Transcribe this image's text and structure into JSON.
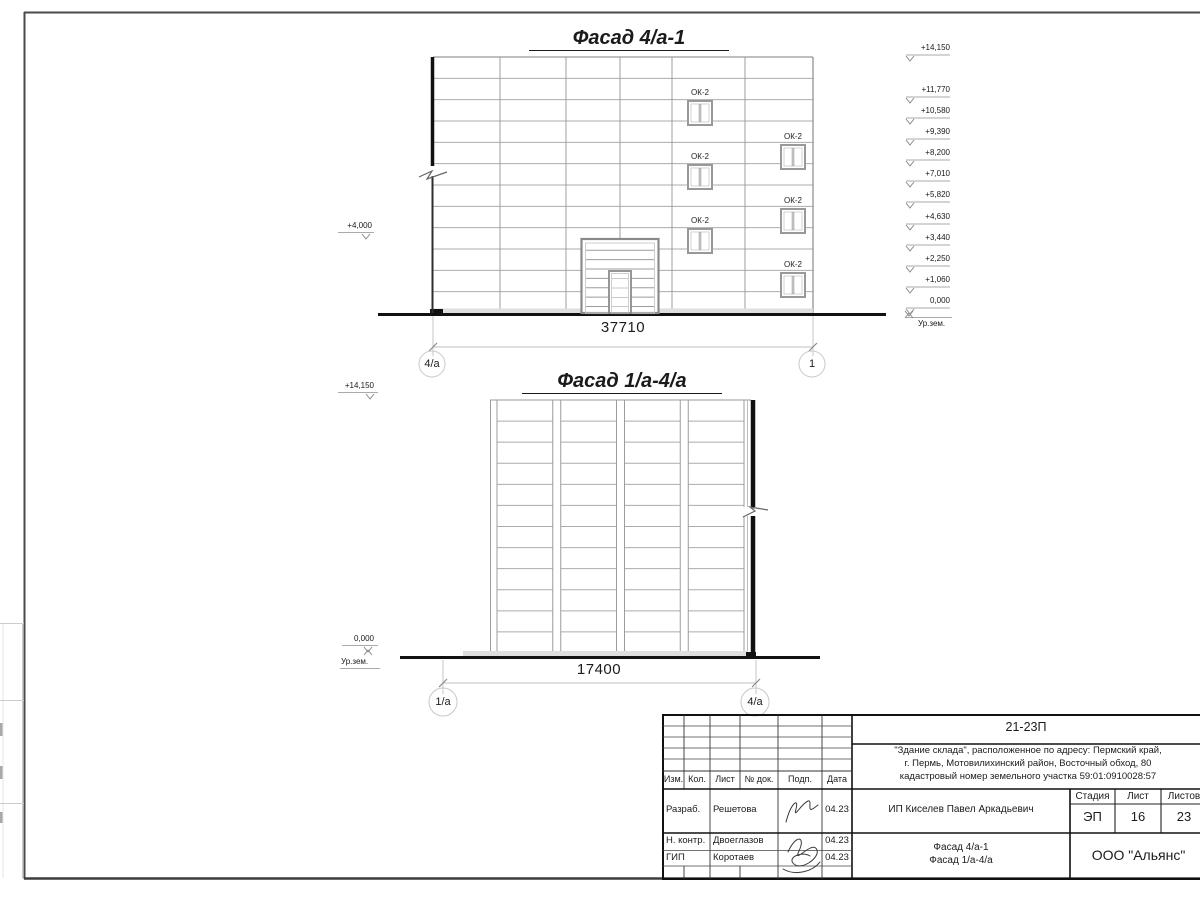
{
  "facade1": {
    "title": "Фасад 4/а-1",
    "window_label": "ОК-2",
    "left_mark": "+4,000",
    "elevations": [
      "+14,150",
      "+11,770",
      "+10,580",
      "+9,390",
      "+8,200",
      "+7,010",
      "+5,820",
      "+4,630",
      "+3,440",
      "+2,250",
      "+1,060",
      "0,000"
    ],
    "ground_label": "Ур.зем.",
    "dimension": "37710",
    "axis_left": "4/а",
    "axis_right": "1"
  },
  "facade2": {
    "title": "Фасад 1/а-4/а",
    "top_mark": "+14,150",
    "zero_mark": "0,000",
    "ground_label": "Ур.зем.",
    "dimension": "17400",
    "axis_left": "1/а",
    "axis_right": "4/а"
  },
  "title_block": {
    "code": "21-23П",
    "address_line1": "\"Здание склада\", расположенное по адресу: Пермский край,",
    "address_line2": "г. Пермь, Мотовилихинский район, Восточный обход, 80",
    "address_line3": "кадастровый номер земельного участка 59:01:0910028:57",
    "headers": {
      "izm": "Изм.",
      "kol": "Кол.",
      "list": "Лист",
      "doc": "№ док.",
      "podp": "Подп.",
      "data": "Дата",
      "stadia": "Стадия",
      "list2": "Лист",
      "listov": "Листов"
    },
    "rows": [
      {
        "role": "Разраб.",
        "name": "Решетова",
        "date": "04.23"
      },
      {
        "role": "Н. контр.",
        "name": "Двоеглазов",
        "date": "04.23"
      },
      {
        "role": "ГИП",
        "name": "Коротаев",
        "date": "04.23"
      }
    ],
    "client": "ИП Киселев Павел Аркадьевич",
    "stage": "ЭП",
    "sheet_no": "16",
    "sheets_total": "23",
    "drawing_title_line1": "Фасад 4/а-1",
    "drawing_title_line2": "Фасад 1/а-4/а",
    "company": "ООО \"Альянс\""
  }
}
